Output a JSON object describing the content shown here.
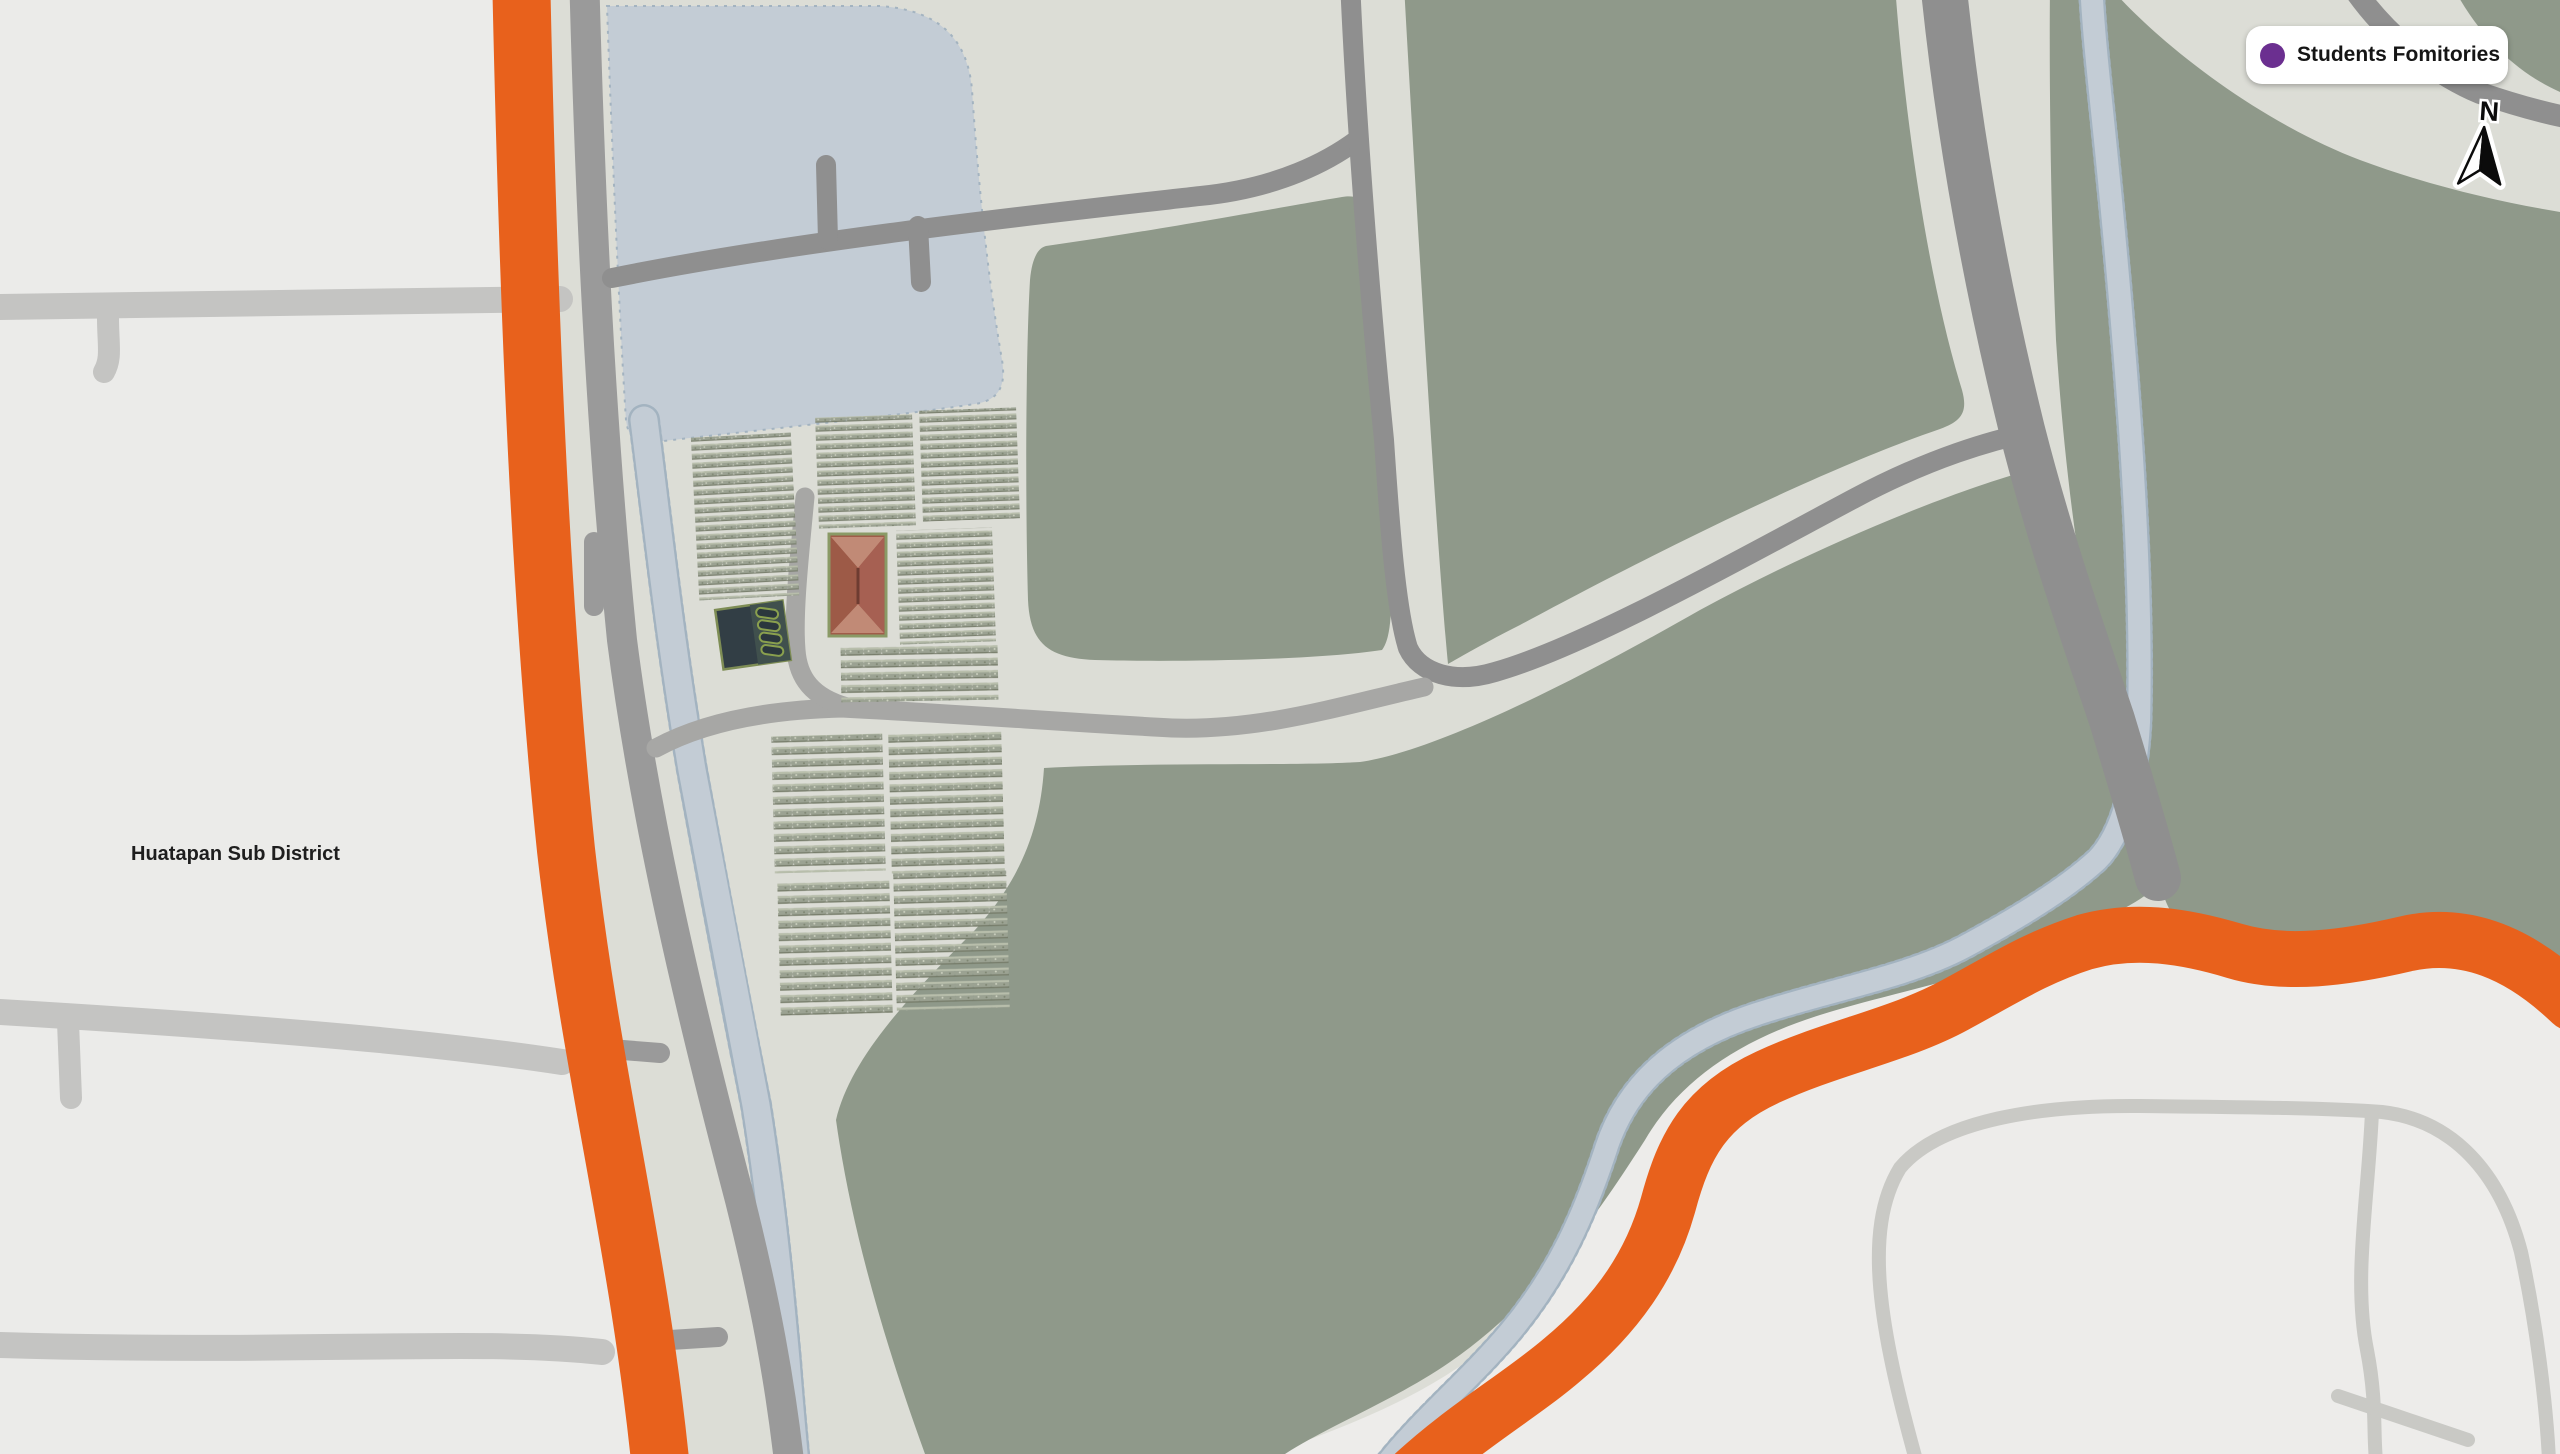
{
  "legend": {
    "items": [
      {
        "label": "Students Fomitories",
        "color": "#6b2f90"
      }
    ]
  },
  "map": {
    "district_label": "Huatapan Sub District",
    "compass_label": "N",
    "colors": {
      "highway_orange": "#e8611c",
      "road_dark_gray": "#8f8f8f",
      "road_light_gray": "#c4c4c2",
      "water_blue": "#c3ccd5",
      "field_olive": "#8f998a",
      "ground_light": "#dcddd6",
      "outskirts_light": "#ebebe9",
      "dormitory_row_sage": "#9ba292",
      "red_roof_building": "#a05c49",
      "dark_building": "#323e45",
      "legend_dot_purple": "#6b2f90"
    }
  }
}
